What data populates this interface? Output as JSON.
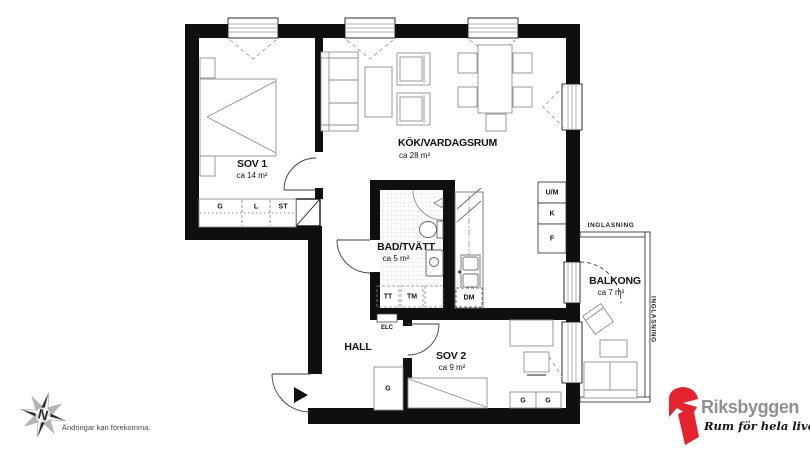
{
  "rooms": [
    {
      "name": "SOV 1",
      "area": "ca 14 m²"
    },
    {
      "name": "KÖK/VARDAGSRUM",
      "area": "ca 28 m²"
    },
    {
      "name": "BAD/TVÄTT",
      "area": "ca 5 m²"
    },
    {
      "name": "HALL",
      "area": ""
    },
    {
      "name": "SOV 2",
      "area": "ca 9 m²"
    },
    {
      "name": "BALKONG",
      "area": "ca 7 m²"
    }
  ],
  "wardrobes": {
    "g": "G",
    "l": "L",
    "st": "ST",
    "hall_g": "G",
    "sov2_g1": "G",
    "sov2_g2": "G"
  },
  "kitchen": {
    "um": "U/M",
    "k": "K",
    "f": "F",
    "dm": "DM"
  },
  "laundry": {
    "tt": "TT",
    "tm": "TM"
  },
  "electrical": {
    "elc": "ELC"
  },
  "glazing": {
    "top": "INGLASNING",
    "right": "INGLASNING"
  },
  "compass": {
    "north": "N"
  },
  "footer": {
    "disclaimer": "Ändringar kan förekomma."
  },
  "branding": {
    "name": "Riksbyggen",
    "tagline": "Rum för hela livet",
    "red": "#e5232e",
    "gray": "#8e9194"
  }
}
